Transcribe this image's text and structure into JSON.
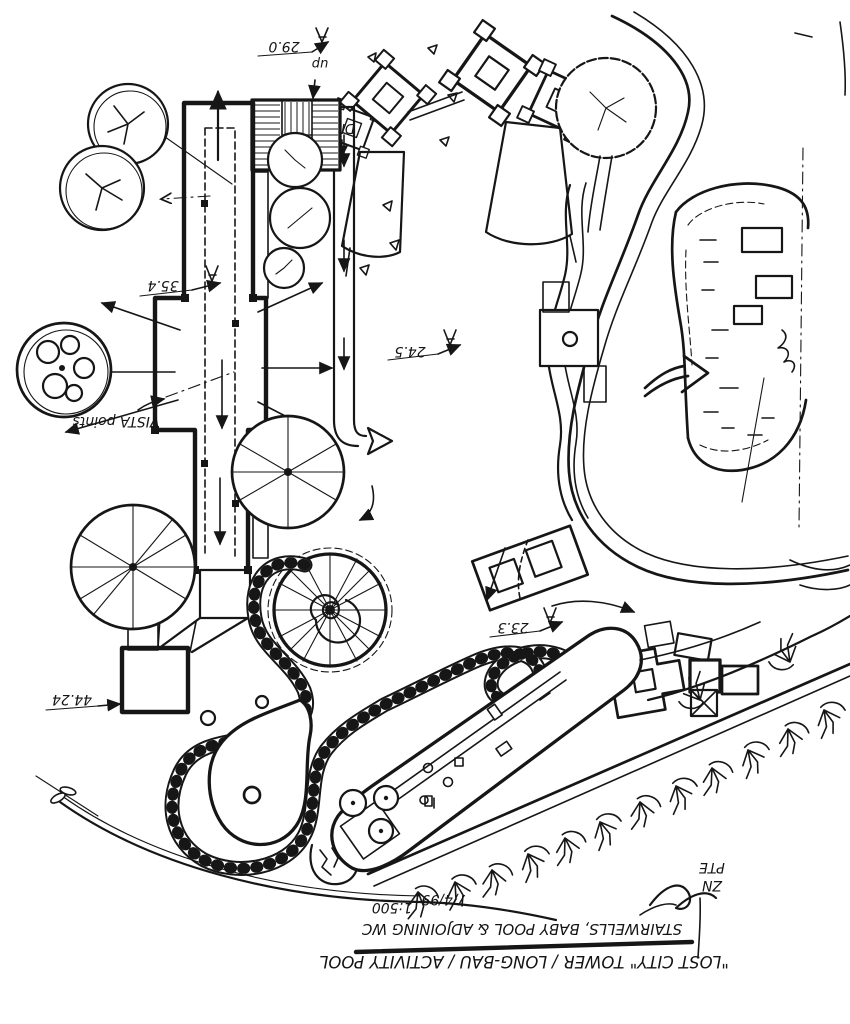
{
  "plan": {
    "orientation_note": "hand-drawn site plan; all lettering on the sheet appears rotated 180°",
    "title_block": {
      "title": "\"LOST CITY\" TOWER / LONG-BAU / ACTIVITY POOL",
      "subtitle": "STAIRWELLS, BABY POOL & ADJOINING WC",
      "date": "7/4/99",
      "scale": "1:500",
      "firm_line1": "ZN",
      "firm_line2": "PTE"
    },
    "labels": {
      "vista_points": "VISTA points",
      "stairs_up": "up",
      "stairs_down": "DN"
    },
    "spot_levels": [
      {
        "value": "29.0"
      },
      {
        "value": "35.4"
      },
      {
        "value": "24.5"
      },
      {
        "value": "23.3"
      },
      {
        "value": "44.24"
      }
    ]
  }
}
